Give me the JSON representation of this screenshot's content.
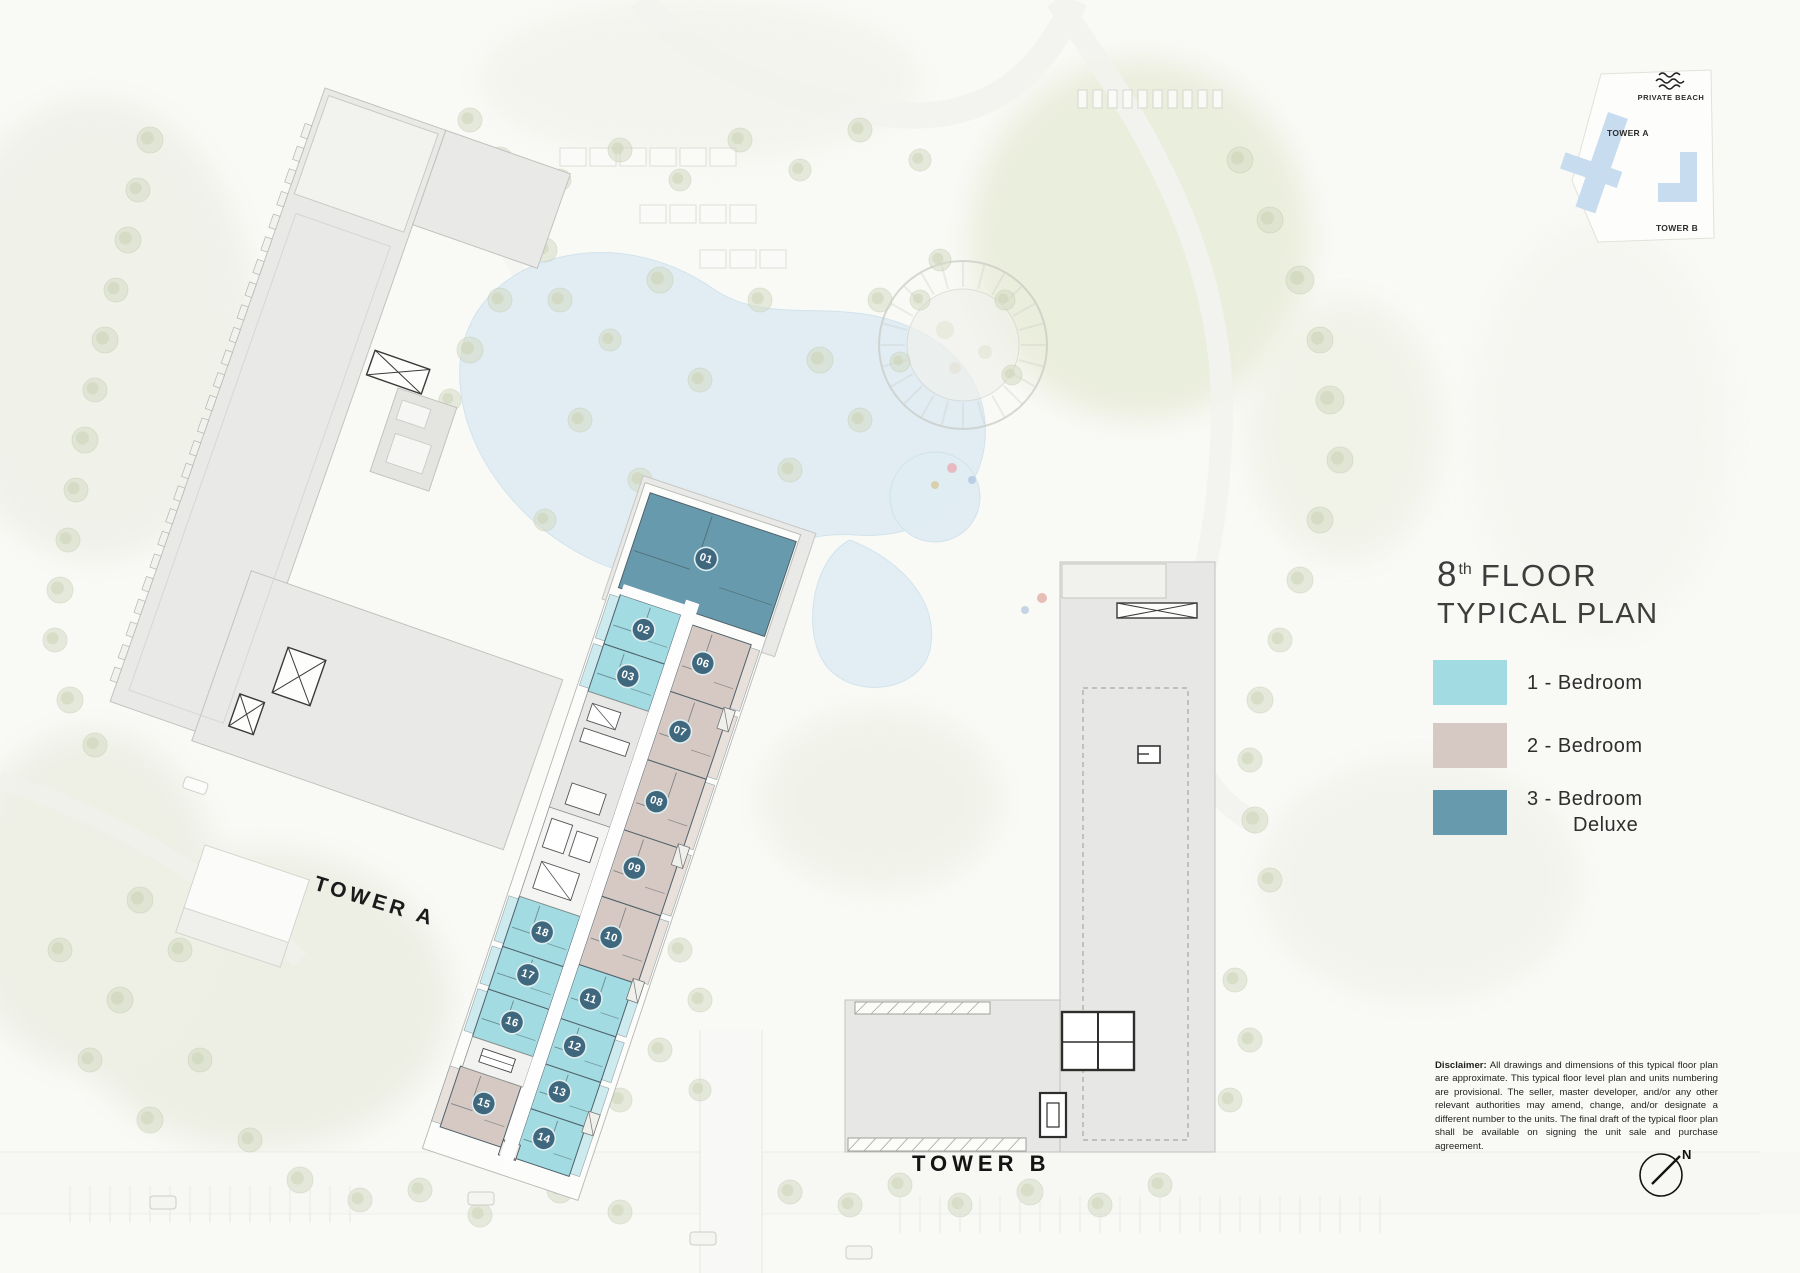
{
  "title": {
    "floor_number": "8",
    "floor_ordinal": "th",
    "floor_word": "FLOOR",
    "line2": "TYPICAL PLAN"
  },
  "legend": {
    "items": [
      {
        "id": "1br",
        "label": "1 - Bedroom",
        "label2": "",
        "color": "#a2dbe1"
      },
      {
        "id": "2br",
        "label": "2 - Bedroom",
        "label2": "",
        "color": "#d6c9c3"
      },
      {
        "id": "3br",
        "label": "3 - Bedroom",
        "label2": "Deluxe",
        "color": "#679aac"
      }
    ]
  },
  "key_plan": {
    "beach_label": "PRIVATE BEACH",
    "tower_a_label": "TOWER A",
    "tower_b_label": "TOWER B",
    "building_color": "#c7dcee"
  },
  "site": {
    "tower_a_label": "TOWER A",
    "tower_b_label": "TOWER B"
  },
  "compass": {
    "label": "N"
  },
  "badge_color": "#3f687e",
  "units": [
    {
      "number": "01",
      "type": "3br"
    },
    {
      "number": "02",
      "type": "1br"
    },
    {
      "number": "03",
      "type": "1br"
    },
    {
      "number": "06",
      "type": "2br"
    },
    {
      "number": "07",
      "type": "2br"
    },
    {
      "number": "08",
      "type": "2br"
    },
    {
      "number": "09",
      "type": "2br"
    },
    {
      "number": "10",
      "type": "2br"
    },
    {
      "number": "11",
      "type": "1br"
    },
    {
      "number": "12",
      "type": "1br"
    },
    {
      "number": "13",
      "type": "1br"
    },
    {
      "number": "14",
      "type": "1br"
    },
    {
      "number": "15",
      "type": "2br"
    },
    {
      "number": "16",
      "type": "1br"
    },
    {
      "number": "17",
      "type": "1br"
    },
    {
      "number": "18",
      "type": "1br"
    }
  ],
  "disclaimer": {
    "lead": "Disclaimer:",
    "body": "All drawings and dimensions of this typical floor plan are approximate. This typical floor level plan and units numbering are provisional. The seller, master developer, and/or any other relevant authorities may amend, change, and/or designate a different number to the units. The final draft of the typical floor plan shall be available on signing the unit sale and purchase agreement."
  }
}
